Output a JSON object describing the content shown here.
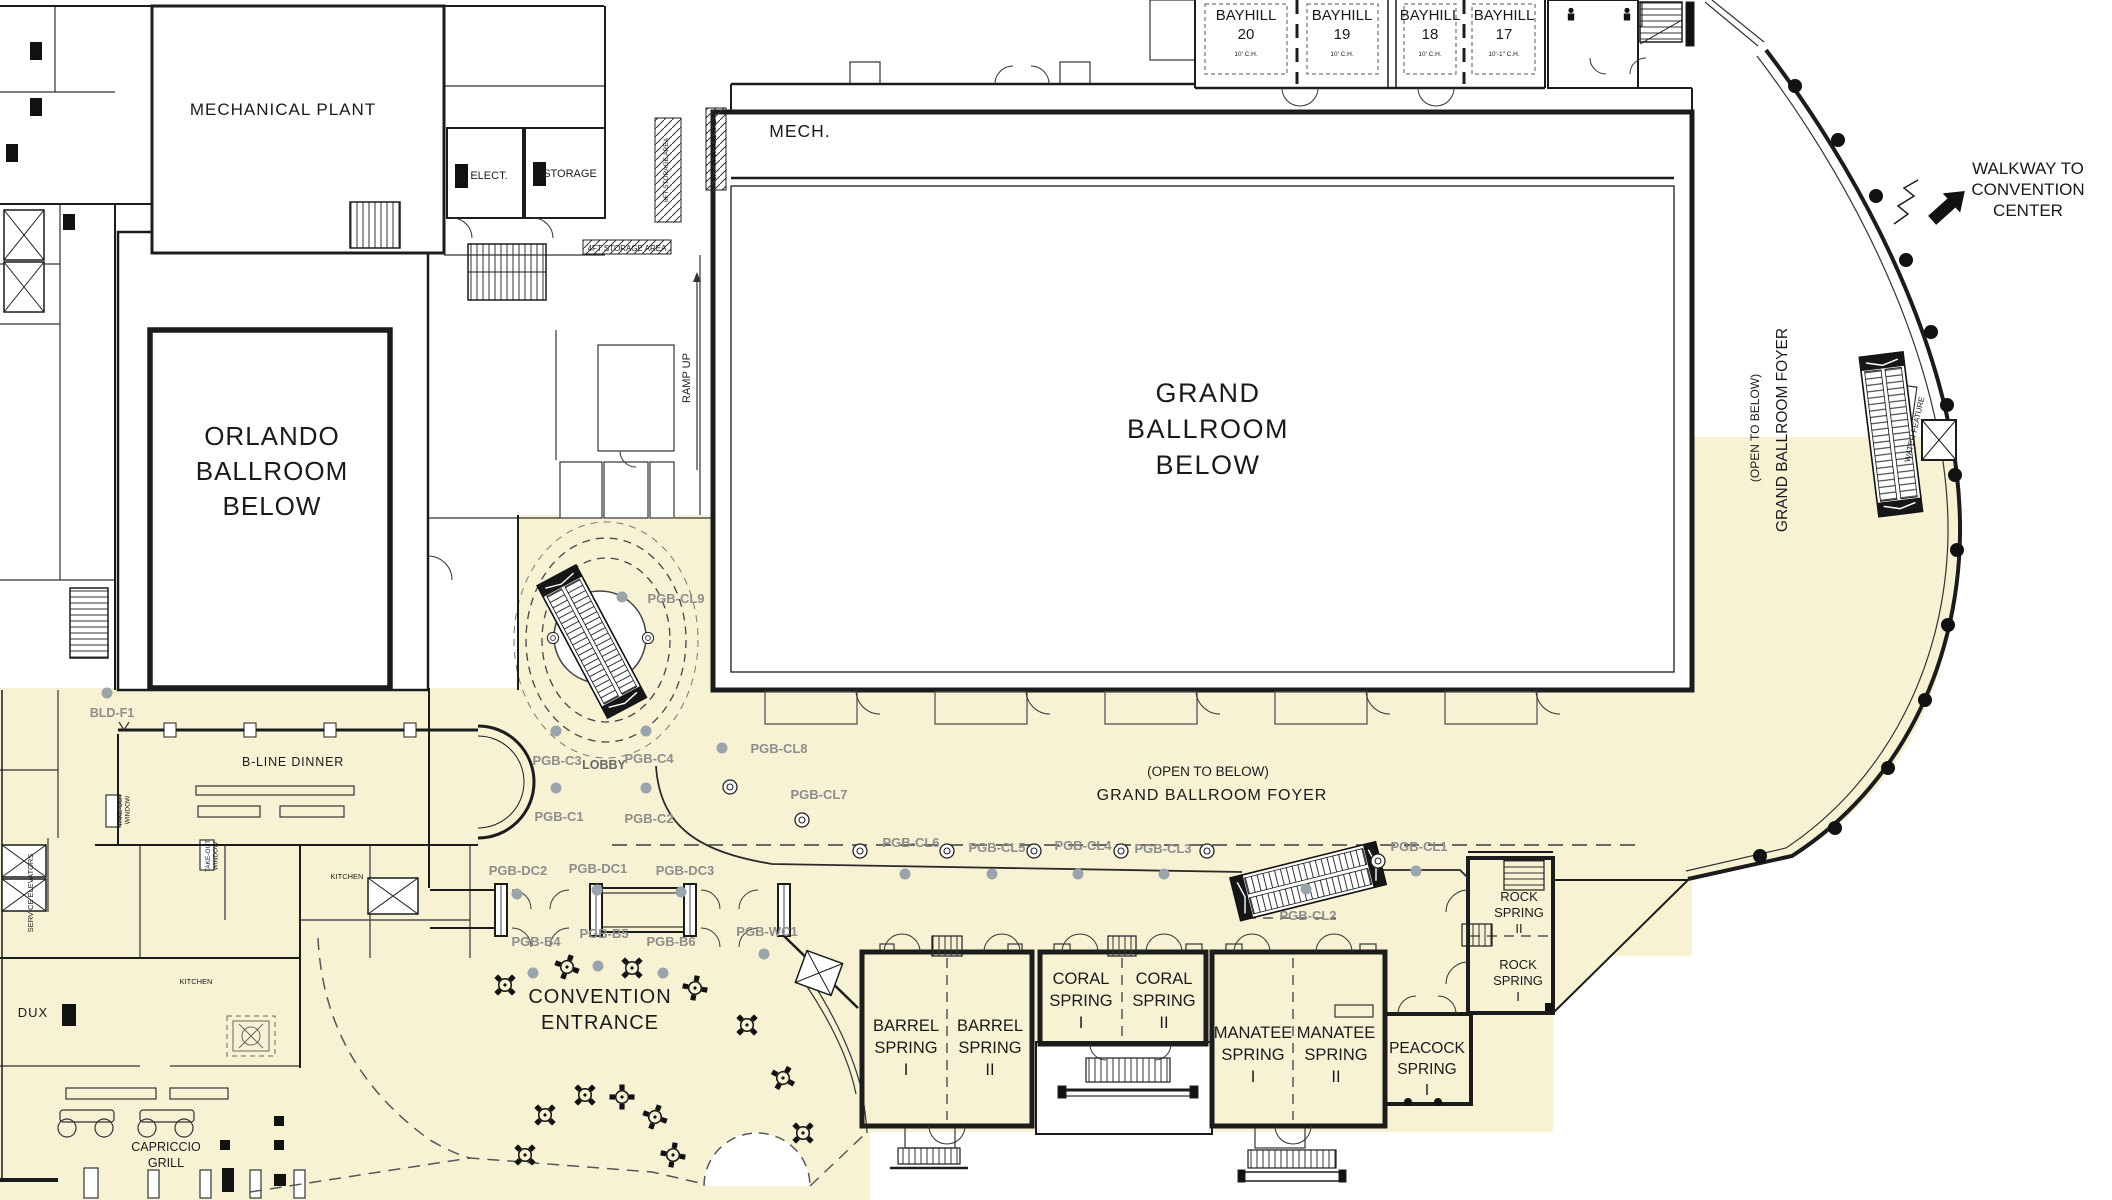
{
  "palette": {
    "cream": "#F8F2D5",
    "wall": "#1c1c1c",
    "marker": "#8d8d8d",
    "column_dot": "#9aa4ab",
    "dash": "#555555"
  },
  "labels": [
    {
      "id": "mechanical-plant-label",
      "x": 283,
      "y": 115,
      "fs": 17,
      "sp": 1,
      "lines": [
        "MECHANICAL PLANT"
      ]
    },
    {
      "id": "elect-label",
      "x": 489,
      "y": 179,
      "fs": 11,
      "lines": [
        "ELECT."
      ]
    },
    {
      "id": "storage-label",
      "x": 570,
      "y": 177,
      "fs": 11,
      "lines": [
        "STORAGE"
      ]
    },
    {
      "id": "mech-label",
      "x": 800,
      "y": 137,
      "fs": 17.5,
      "sp": 1,
      "lines": [
        "MECH."
      ]
    },
    {
      "id": "storage-8ft-a-label",
      "x": 668,
      "y": 170,
      "fs": 6.5,
      "rot": -90,
      "lines": [
        "8FT STORAGE AREA"
      ]
    },
    {
      "id": "storage-8ft-b-label",
      "x": 716,
      "y": 148,
      "fs": 6.5,
      "rot": -90,
      "lines": [
        "8FT STORAGE AREA"
      ]
    },
    {
      "id": "storage-4ft-label",
      "x": 627,
      "y": 251,
      "fs": 8,
      "lines": [
        "4FT STORAGE AREA"
      ]
    },
    {
      "id": "ramp-up-label",
      "x": 690,
      "y": 378,
      "fs": 11,
      "rot": -90,
      "lines": [
        "RAMP UP"
      ]
    },
    {
      "id": "bayhill-20-label",
      "x": 1246,
      "y": 20,
      "fs": 15,
      "lh": 19,
      "lines": [
        "BAYHILL",
        "20"
      ]
    },
    {
      "id": "bayhill-20-ch",
      "x": 1246,
      "y": 56,
      "fs": 6.5,
      "lines": [
        "10' C.H."
      ]
    },
    {
      "id": "bayhill-19-label",
      "x": 1342,
      "y": 20,
      "fs": 15,
      "lh": 19,
      "lines": [
        "BAYHILL",
        "19"
      ]
    },
    {
      "id": "bayhill-19-ch",
      "x": 1342,
      "y": 56,
      "fs": 6.5,
      "lines": [
        "10' C.H."
      ]
    },
    {
      "id": "bayhill-18-label",
      "x": 1430,
      "y": 20,
      "fs": 15,
      "lh": 19,
      "lines": [
        "BAYHILL",
        "18"
      ]
    },
    {
      "id": "bayhill-18-ch",
      "x": 1430,
      "y": 56,
      "fs": 6.5,
      "lines": [
        "10' C.H."
      ]
    },
    {
      "id": "bayhill-17-label",
      "x": 1504,
      "y": 20,
      "fs": 15,
      "lh": 19,
      "lines": [
        "BAYHILL",
        "17"
      ]
    },
    {
      "id": "bayhill-17-ch",
      "x": 1504,
      "y": 56,
      "fs": 6.5,
      "lines": [
        "10'-1\" C.H."
      ]
    },
    {
      "id": "walkway-label",
      "x": 2028,
      "y": 174,
      "fs": 17,
      "lh": 21,
      "lines": [
        "WALKWAY TO",
        "CONVENTION",
        "CENTER"
      ]
    },
    {
      "id": "open-to-below-vertical",
      "x": 1759,
      "y": 428,
      "fs": 12,
      "rot": -90,
      "lines": [
        "(OPEN TO BELOW)"
      ]
    },
    {
      "id": "grand-ballroom-foyer-vertical",
      "x": 1787,
      "y": 430,
      "fs": 15.5,
      "rot": -90,
      "lines": [
        "GRAND BALLROOM FOYER"
      ]
    },
    {
      "id": "water-feature-label",
      "x": 1917,
      "y": 430,
      "fs": 8,
      "rot": -77,
      "lines": [
        "WATER FEATURE"
      ]
    },
    {
      "id": "grand-ballroom-label",
      "x": 1208,
      "y": 402,
      "fs": 27,
      "lh": 36,
      "sp": 1.5,
      "lines": [
        "GRAND",
        "BALLROOM",
        "BELOW"
      ]
    },
    {
      "id": "orlando-ballroom-label",
      "x": 272,
      "y": 445,
      "fs": 26,
      "lh": 35,
      "sp": 1,
      "lines": [
        "ORLANDO",
        "BALLROOM",
        "BELOW"
      ]
    },
    {
      "id": "open-to-below-horizontal",
      "x": 1208,
      "y": 776,
      "fs": 13.5,
      "lines": [
        "(OPEN TO BELOW)"
      ]
    },
    {
      "id": "grand-ballroom-foyer-horizontal",
      "x": 1212,
      "y": 800,
      "fs": 16,
      "sp": 1,
      "lines": [
        "GRAND BALLROOM FOYER"
      ]
    },
    {
      "id": "bline-dinner-label",
      "x": 293,
      "y": 766,
      "fs": 12.5,
      "sp": 0.8,
      "lines": [
        "B-LINE DINNER"
      ]
    },
    {
      "id": "bld-f1-label",
      "x": 112,
      "y": 717,
      "fs": 12.5,
      "c": "marker",
      "w": 700,
      "lines": [
        "BLD-F1"
      ]
    },
    {
      "id": "takeout-window-a-label",
      "x": 210,
      "y": 856,
      "fs": 6.5,
      "rot": -90,
      "lh": 7.5,
      "lines": [
        "TAKE-OUT",
        "WINDOW"
      ]
    },
    {
      "id": "takeout-window-b-label",
      "x": 122,
      "y": 810,
      "fs": 6.5,
      "rot": -90,
      "lh": 7.5,
      "lines": [
        "TAKE-OUT",
        "WINDOW"
      ]
    },
    {
      "id": "service-elevators-label",
      "x": 33,
      "y": 893,
      "fs": 7.5,
      "rot": -90,
      "lines": [
        "SERVICE ELEVATORS"
      ]
    },
    {
      "id": "kitchen-a-label",
      "x": 347,
      "y": 879,
      "fs": 7.5,
      "lines": [
        "KITCHEN"
      ]
    },
    {
      "id": "kitchen-b-label",
      "x": 196,
      "y": 984,
      "fs": 7.5,
      "lines": [
        "KITCHEN"
      ]
    },
    {
      "id": "dux-label",
      "x": 33,
      "y": 1017,
      "fs": 13,
      "sp": 1,
      "lines": [
        "DUX"
      ]
    },
    {
      "id": "capriccio-grill-label",
      "x": 166,
      "y": 1151,
      "fs": 12.5,
      "lh": 16,
      "lines": [
        "CAPRICCIO",
        "GRILL"
      ]
    },
    {
      "id": "convention-entrance-label",
      "x": 600,
      "y": 1003,
      "fs": 20,
      "lh": 26,
      "sp": 1,
      "lines": [
        "CONVENTION",
        "ENTRANCE"
      ]
    },
    {
      "id": "lobby-label",
      "x": 604,
      "y": 769,
      "fs": 12.5,
      "c": "mid",
      "w": 700,
      "lines": [
        "LOBBY"
      ]
    },
    {
      "id": "pgb-cl9-label",
      "x": 676,
      "y": 603,
      "fs": 13,
      "c": "marker",
      "w": 700,
      "lines": [
        "PGB-CL9"
      ]
    },
    {
      "id": "pgb-cl8-label",
      "x": 779,
      "y": 753,
      "fs": 13,
      "c": "marker",
      "w": 700,
      "lines": [
        "PGB-CL8"
      ]
    },
    {
      "id": "pgb-cl7-label",
      "x": 819,
      "y": 799,
      "fs": 13,
      "c": "marker",
      "w": 700,
      "lines": [
        "PGB-CL7"
      ]
    },
    {
      "id": "pgb-cl6-label",
      "x": 911,
      "y": 847,
      "fs": 13,
      "c": "marker",
      "w": 700,
      "lines": [
        "PGB-CL6"
      ]
    },
    {
      "id": "pgb-cl5-label",
      "x": 997,
      "y": 852,
      "fs": 13,
      "c": "marker",
      "w": 700,
      "lines": [
        "PGB-CL5"
      ]
    },
    {
      "id": "pgb-cl4-label",
      "x": 1083,
      "y": 850,
      "fs": 13,
      "c": "marker",
      "w": 700,
      "lines": [
        "PGB-CL4"
      ]
    },
    {
      "id": "pgb-cl3-label",
      "x": 1163,
      "y": 853,
      "fs": 13,
      "c": "marker",
      "w": 700,
      "lines": [
        "PGB-CL3"
      ]
    },
    {
      "id": "pgb-cl1-label",
      "x": 1419,
      "y": 851,
      "fs": 13,
      "c": "marker",
      "w": 700,
      "lines": [
        "PGB-CL1"
      ]
    },
    {
      "id": "pgb-cl2-label",
      "x": 1308,
      "y": 920,
      "fs": 13,
      "c": "marker",
      "w": 700,
      "lines": [
        "PGB-CL2"
      ]
    },
    {
      "id": "pgb-c3-label",
      "x": 557,
      "y": 765,
      "fs": 13,
      "c": "marker",
      "w": 700,
      "lines": [
        "PGB-C3"
      ]
    },
    {
      "id": "pgb-c4-label",
      "x": 649,
      "y": 763,
      "fs": 13,
      "c": "marker",
      "w": 700,
      "lines": [
        "PGB-C4"
      ]
    },
    {
      "id": "pgb-c1-label",
      "x": 559,
      "y": 821,
      "fs": 13,
      "c": "marker",
      "w": 700,
      "lines": [
        "PGB-C1"
      ]
    },
    {
      "id": "pgb-c2-label",
      "x": 649,
      "y": 823,
      "fs": 13,
      "c": "marker",
      "w": 700,
      "lines": [
        "PGB-C2"
      ]
    },
    {
      "id": "pgb-dc2-label",
      "x": 518,
      "y": 875,
      "fs": 13,
      "c": "marker",
      "w": 700,
      "lines": [
        "PGB-DC2"
      ]
    },
    {
      "id": "pgb-dc1-label",
      "x": 598,
      "y": 873,
      "fs": 13,
      "c": "marker",
      "w": 700,
      "lines": [
        "PGB-DC1"
      ]
    },
    {
      "id": "pgb-dc3-label",
      "x": 685,
      "y": 875,
      "fs": 13,
      "c": "marker",
      "w": 700,
      "lines": [
        "PGB-DC3"
      ]
    },
    {
      "id": "pgb-b4-label",
      "x": 536,
      "y": 946,
      "fs": 13,
      "c": "marker",
      "w": 700,
      "lines": [
        "PGB-B4"
      ]
    },
    {
      "id": "pgb-b5-label",
      "x": 604,
      "y": 938,
      "fs": 13,
      "c": "marker",
      "w": 700,
      "lines": [
        "PGB-B5"
      ]
    },
    {
      "id": "pgb-b6-label",
      "x": 671,
      "y": 946,
      "fs": 13,
      "c": "marker",
      "w": 700,
      "lines": [
        "PGB-B6"
      ]
    },
    {
      "id": "pgb-wc1-label",
      "x": 767,
      "y": 936,
      "fs": 13,
      "c": "marker",
      "w": 700,
      "lines": [
        "PGB-WC1"
      ]
    },
    {
      "id": "barrel-spring-i-label",
      "x": 906,
      "y": 1031,
      "fs": 16.5,
      "lh": 22,
      "lines": [
        "BARREL",
        "SPRING",
        "I"
      ]
    },
    {
      "id": "barrel-spring-ii-label",
      "x": 990,
      "y": 1031,
      "fs": 16.5,
      "lh": 22,
      "lines": [
        "BARREL",
        "SPRING",
        "II"
      ]
    },
    {
      "id": "coral-spring-i-label",
      "x": 1081,
      "y": 984,
      "fs": 16.5,
      "lh": 22,
      "lines": [
        "CORAL",
        "SPRING",
        "I"
      ]
    },
    {
      "id": "coral-spring-ii-label",
      "x": 1164,
      "y": 984,
      "fs": 16.5,
      "lh": 22,
      "lines": [
        "CORAL",
        "SPRING",
        "II"
      ]
    },
    {
      "id": "manatee-spring-i-label",
      "x": 1253,
      "y": 1038,
      "fs": 16.5,
      "lh": 22,
      "lines": [
        "MANATEE",
        "SPRING",
        "I"
      ]
    },
    {
      "id": "manatee-spring-ii-label",
      "x": 1336,
      "y": 1038,
      "fs": 16.5,
      "lh": 22,
      "lines": [
        "MANATEE",
        "SPRING",
        "II"
      ]
    },
    {
      "id": "peacock-spring-label",
      "x": 1427,
      "y": 1053,
      "fs": 15.5,
      "lh": 21,
      "lines": [
        "PEACOCK",
        "SPRING",
        "I"
      ]
    },
    {
      "id": "rock-spring-ii-label",
      "x": 1519,
      "y": 901,
      "fs": 13,
      "lh": 16,
      "lines": [
        "ROCK",
        "SPRING",
        "II"
      ]
    },
    {
      "id": "rock-spring-i-label",
      "x": 1518,
      "y": 969,
      "fs": 13,
      "lh": 16,
      "lines": [
        "ROCK",
        "SPRING",
        "I"
      ]
    }
  ]
}
